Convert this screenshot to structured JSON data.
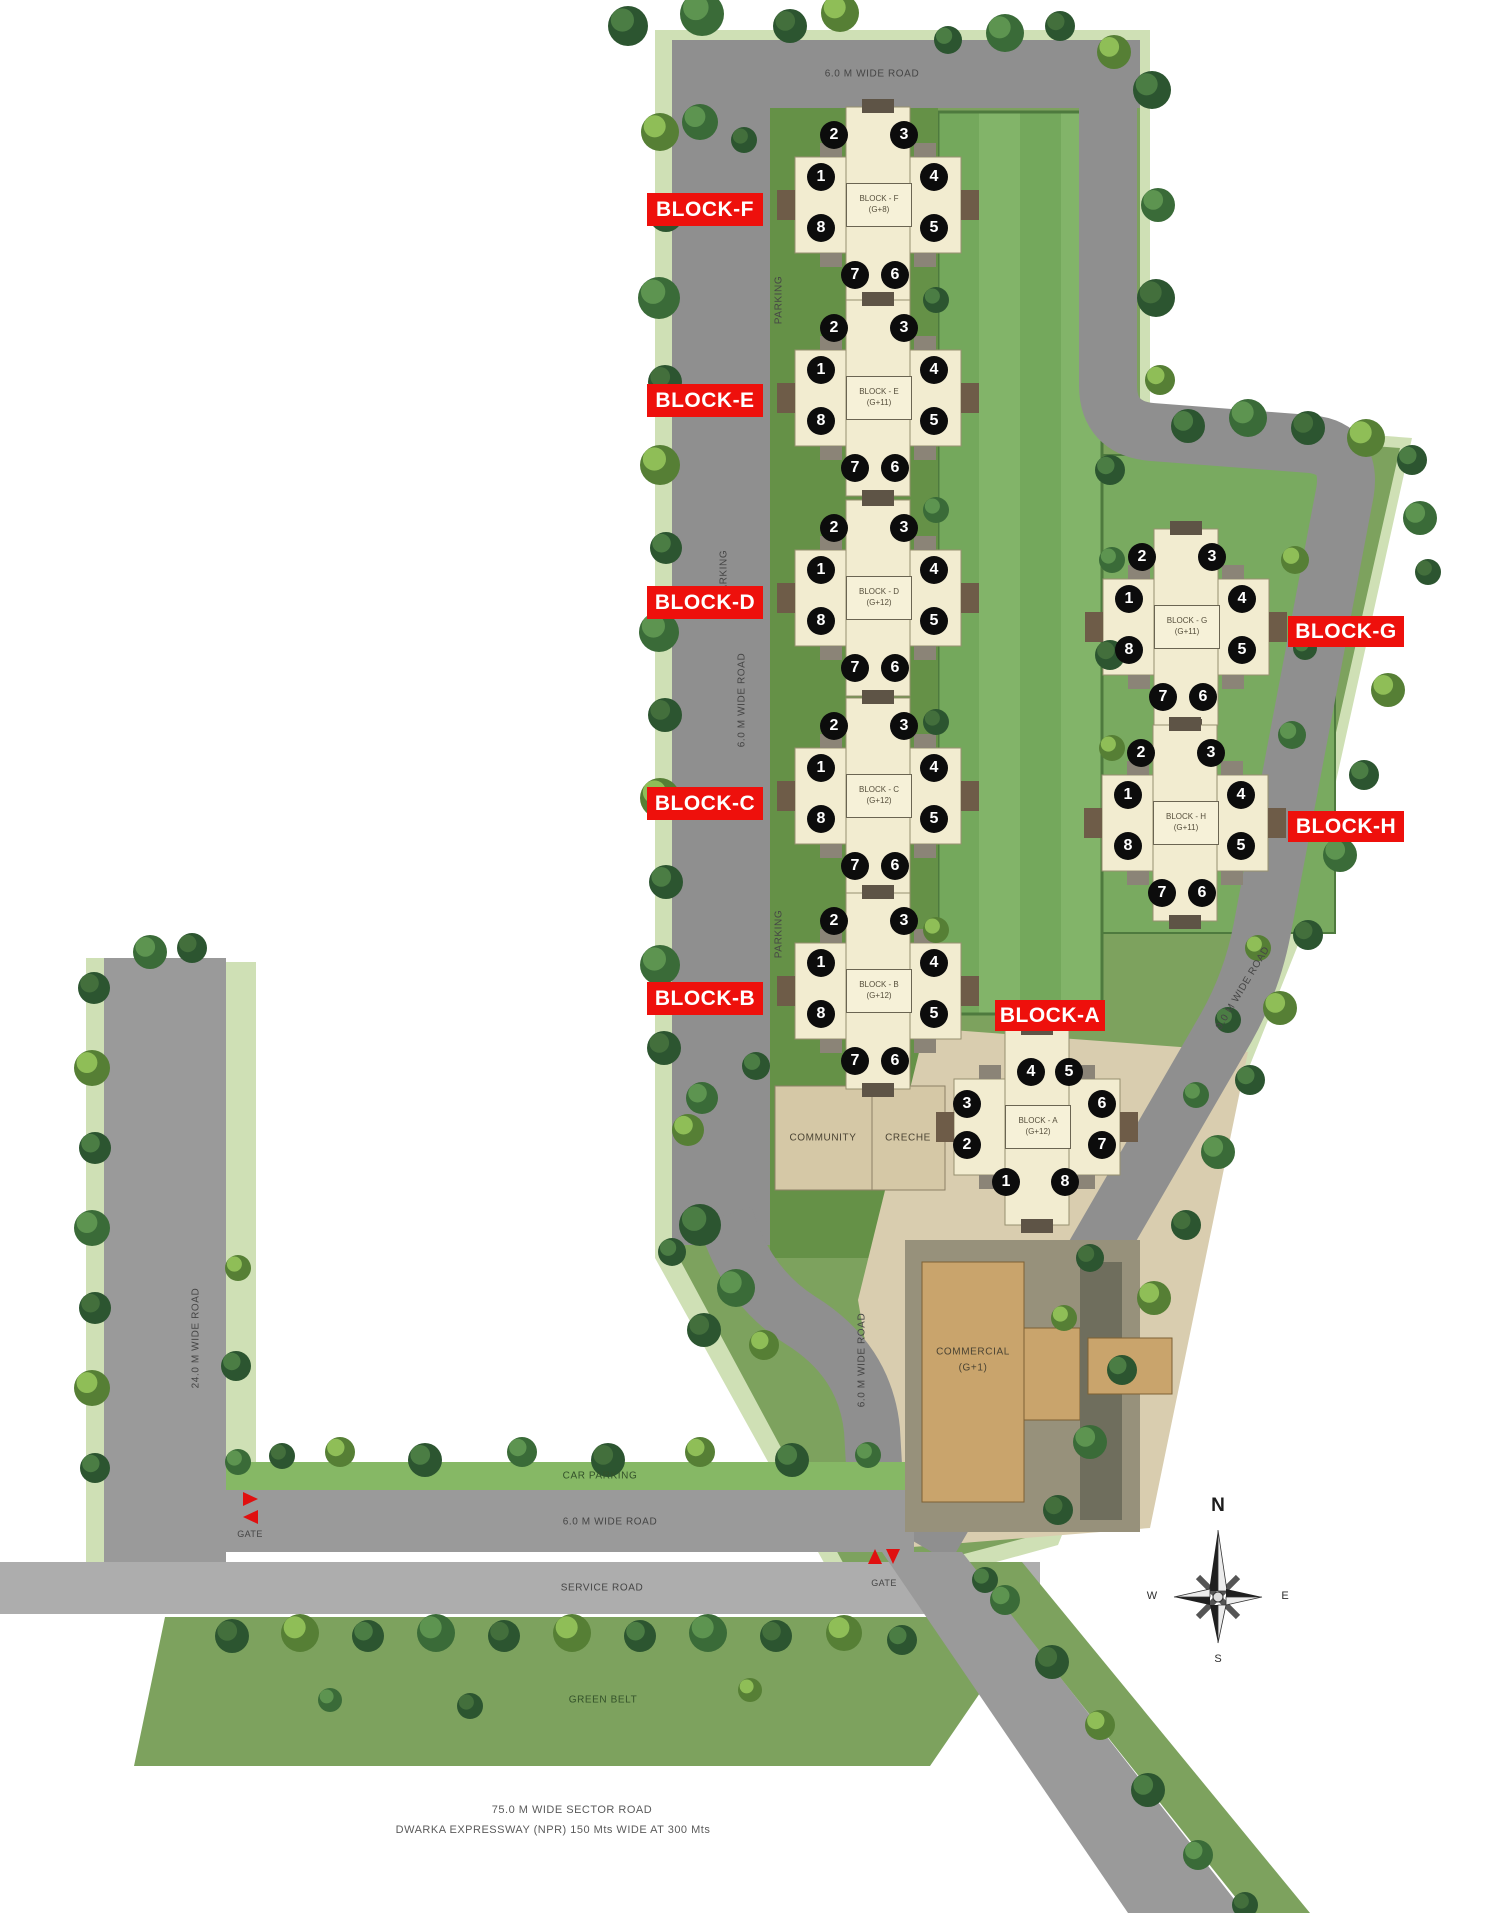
{
  "site": {
    "compass": {
      "north": "N",
      "east": "E",
      "south": "S",
      "west": "W"
    },
    "roads": {
      "top_road": "6.0 M WIDE ROAD",
      "left_road_vertical": "6.0 M WIDE ROAD",
      "inner_road_vertical": "6.0 M WIDE ROAD",
      "right_road_diagonal": "9.0 M WIDE ROAD",
      "west_road": "24.0 M WIDE ROAD",
      "bottom_road": "6.0 M WIDE ROAD",
      "service_road": "SERVICE ROAD",
      "sector_road_line1": "75.0 M WIDE SECTOR ROAD",
      "sector_road_line2": "DWARKA EXPRESSWAY (NPR) 150 Mts WIDE AT 300 Mts"
    },
    "areas": {
      "parking": "PARKING",
      "car_parking": "CAR PARKING",
      "green_belt": "GREEN BELT",
      "community": "COMMUNITY",
      "creche": "CRECHE",
      "commercial_line1": "COMMERCIAL",
      "commercial_line2": "(G+1)",
      "gate": "GATE"
    },
    "blocks": [
      {
        "tag": "BLOCK-F",
        "name": "BLOCK - F",
        "floors": "(G+8)"
      },
      {
        "tag": "BLOCK-E",
        "name": "BLOCK - E",
        "floors": "(G+11)"
      },
      {
        "tag": "BLOCK-D",
        "name": "BLOCK - D",
        "floors": "(G+12)"
      },
      {
        "tag": "BLOCK-C",
        "name": "BLOCK - C",
        "floors": "(G+12)"
      },
      {
        "tag": "BLOCK-B",
        "name": "BLOCK - B",
        "floors": "(G+12)"
      },
      {
        "tag": "BLOCK-A",
        "name": "BLOCK - A",
        "floors": "(G+12)"
      },
      {
        "tag": "BLOCK-G",
        "name": "BLOCK - G",
        "floors": "(G+11)"
      },
      {
        "tag": "BLOCK-H",
        "name": "BLOCK - H",
        "floors": "(G+11)"
      }
    ],
    "unit_numbers": [
      "1",
      "2",
      "3",
      "4",
      "5",
      "6",
      "7",
      "8"
    ],
    "colors": {
      "label_red": "#ee100c",
      "site_green": "#7da25e",
      "lawn_green": "#74a85c",
      "road_grey": "#8f8f8f",
      "tower_cream": "#f2ecd0",
      "commercial_tan": "#c9a46c",
      "unit_circle_black": "#0c0c0c"
    }
  }
}
